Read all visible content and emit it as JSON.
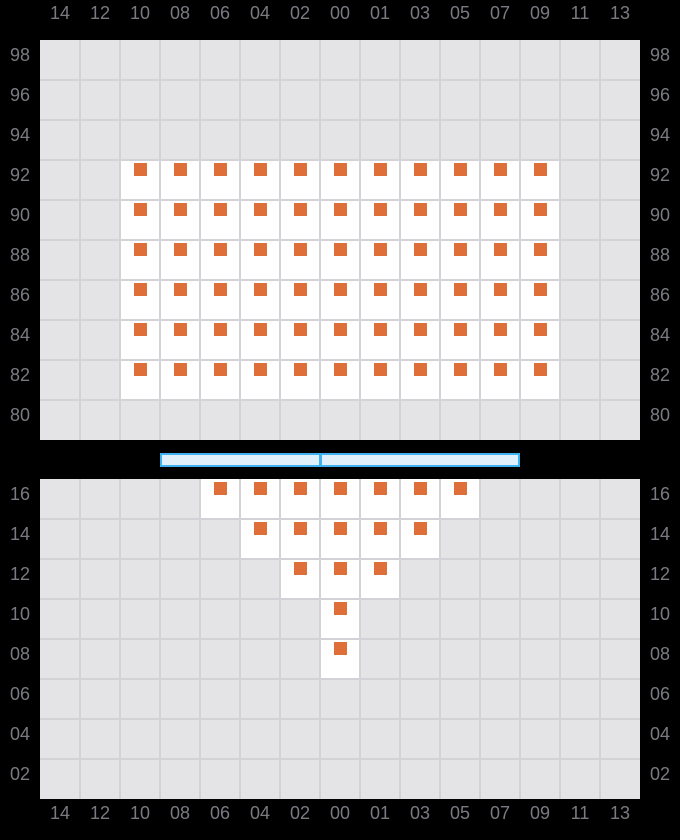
{
  "colors": {
    "background": "#000000",
    "panel_bg": "#e4e4e6",
    "grid_line": "#d3d3d7",
    "active_cell": "#ffffff",
    "token": "#de6f38",
    "axis_label": "#7a7b82",
    "slider_border": "#3eb1ee",
    "slider_fill": "#e0f0fb"
  },
  "slider": {
    "divider_offset_px": 157
  },
  "chart_data": {
    "type": "heatmap",
    "title": "",
    "xlabel": "",
    "ylabel": "",
    "grid": true,
    "legend_position": "none",
    "column_labels": [
      "14",
      "12",
      "10",
      "08",
      "06",
      "04",
      "02",
      "00",
      "01",
      "03",
      "05",
      "07",
      "09",
      "11",
      "13"
    ],
    "marker": "orange-square",
    "panels": [
      {
        "name": "upper",
        "row_labels": [
          "98",
          "96",
          "94",
          "92",
          "90",
          "88",
          "86",
          "84",
          "82",
          "80"
        ],
        "filled": {
          "92": [
            "10",
            "08",
            "06",
            "04",
            "02",
            "00",
            "01",
            "03",
            "05",
            "07",
            "09"
          ],
          "90": [
            "10",
            "08",
            "06",
            "04",
            "02",
            "00",
            "01",
            "03",
            "05",
            "07",
            "09"
          ],
          "88": [
            "10",
            "08",
            "06",
            "04",
            "02",
            "00",
            "01",
            "03",
            "05",
            "07",
            "09"
          ],
          "86": [
            "10",
            "08",
            "06",
            "04",
            "02",
            "00",
            "01",
            "03",
            "05",
            "07",
            "09"
          ],
          "84": [
            "10",
            "08",
            "06",
            "04",
            "02",
            "00",
            "01",
            "03",
            "05",
            "07",
            "09"
          ],
          "82": [
            "10",
            "08",
            "06",
            "04",
            "02",
            "00",
            "01",
            "03",
            "05",
            "07",
            "09"
          ]
        }
      },
      {
        "name": "lower",
        "row_labels": [
          "16",
          "14",
          "12",
          "10",
          "08",
          "06",
          "04",
          "02"
        ],
        "filled": {
          "16": [
            "06",
            "04",
            "02",
            "00",
            "01",
            "03",
            "05"
          ],
          "14": [
            "04",
            "02",
            "00",
            "01",
            "03"
          ],
          "12": [
            "02",
            "00",
            "01"
          ],
          "10": [
            "00"
          ],
          "08": [
            "00"
          ]
        }
      }
    ]
  }
}
